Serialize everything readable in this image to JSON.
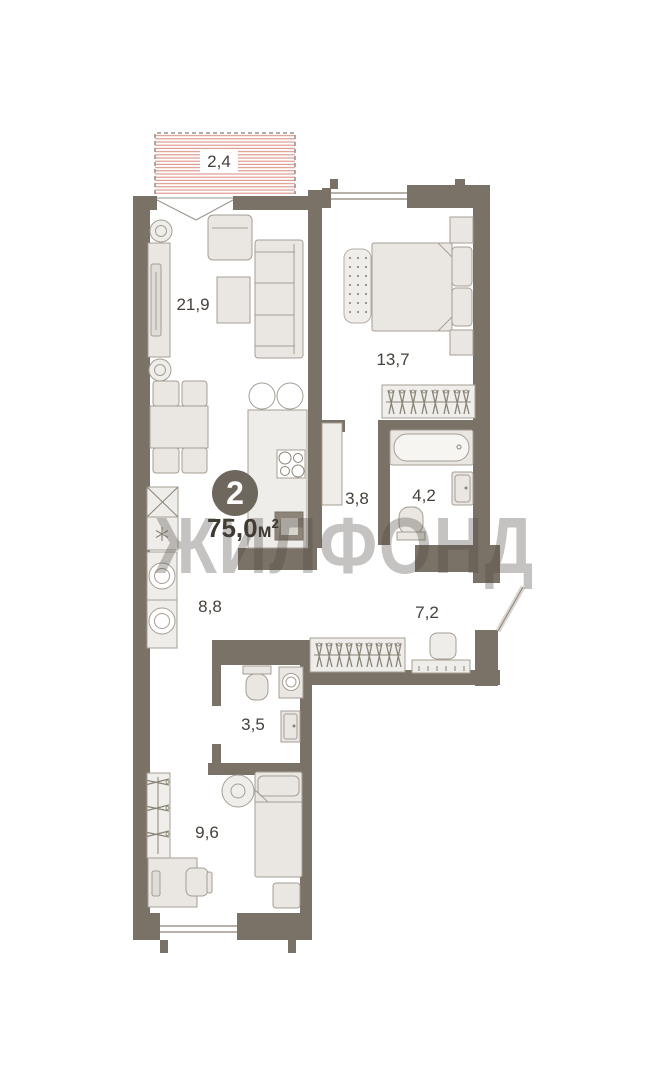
{
  "watermark": "ЖИЛФОНД",
  "badge": {
    "rooms_count": "2"
  },
  "total_area": {
    "value": "75,0",
    "unit": "м",
    "exponent": "2"
  },
  "rooms": [
    {
      "name": "balcony",
      "area": "2,4"
    },
    {
      "name": "living-room",
      "area": "21,9"
    },
    {
      "name": "bedroom-1",
      "area": "13,7"
    },
    {
      "name": "hall",
      "area": "3,8"
    },
    {
      "name": "bathroom",
      "area": "4,2"
    },
    {
      "name": "kitchen-area",
      "area": "8,8"
    },
    {
      "name": "hallway",
      "area": "7,2"
    },
    {
      "name": "toilet",
      "area": "3,5"
    },
    {
      "name": "bedroom-2",
      "area": "9,6"
    }
  ],
  "colors": {
    "wall": "#7b7267",
    "furniture_fill": "#eae7e2",
    "furniture_stroke": "#a49e94",
    "balcony_stripe": "#dd9288",
    "badge_background": "#6e675d",
    "badge_text": "#ffffff",
    "label_text": "#46413a",
    "watermark": "#4e4840"
  }
}
